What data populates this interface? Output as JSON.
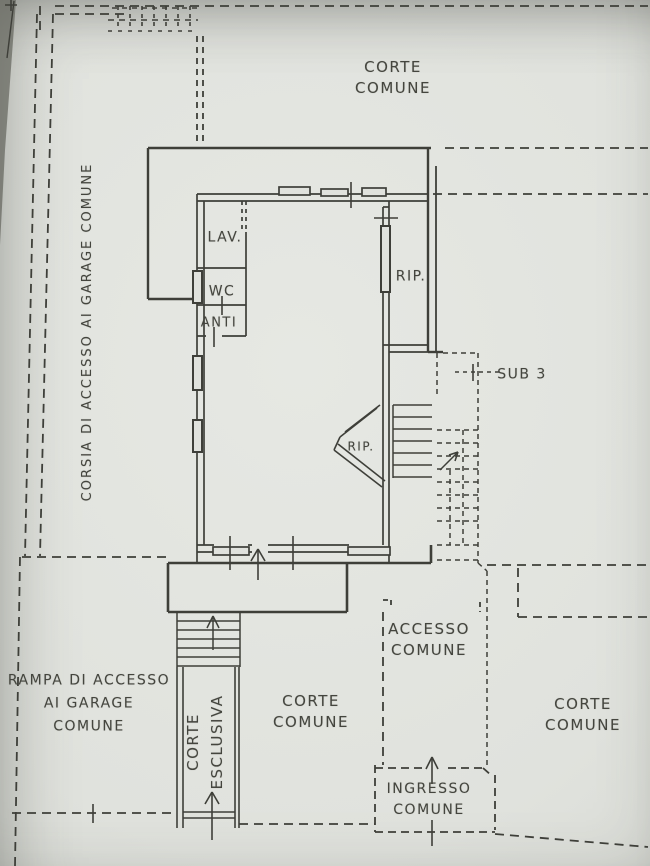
{
  "colors": {
    "paper": "#e0e2dd",
    "ink": "#3e3f39"
  },
  "labels": {
    "corte_comune_top": [
      "CORTE",
      "COMUNE"
    ],
    "corsia_garage": "CORSIA DI ACCESSO AI GARAGE COMUNE",
    "lav": "LAV.",
    "wc": "WC",
    "anti": "ANTI",
    "rip_grande": "RIP.",
    "rip_piccolo": "RIP.",
    "sub3": "SUB 3",
    "accesso_comune": [
      "ACCESSO",
      "COMUNE"
    ],
    "rampa_garage": [
      "RAMPA DI ACCESSO",
      "AI GARAGE",
      "COMUNE"
    ],
    "corte_esclusiva": [
      "CORTE",
      "ESCLUSIVA"
    ],
    "corte_comune_centro": [
      "CORTE",
      "COMUNE"
    ],
    "corte_comune_destra": [
      "CORTE",
      "COMUNE"
    ],
    "ingresso_comune": [
      "INGRESSO",
      "COMUNE"
    ]
  }
}
